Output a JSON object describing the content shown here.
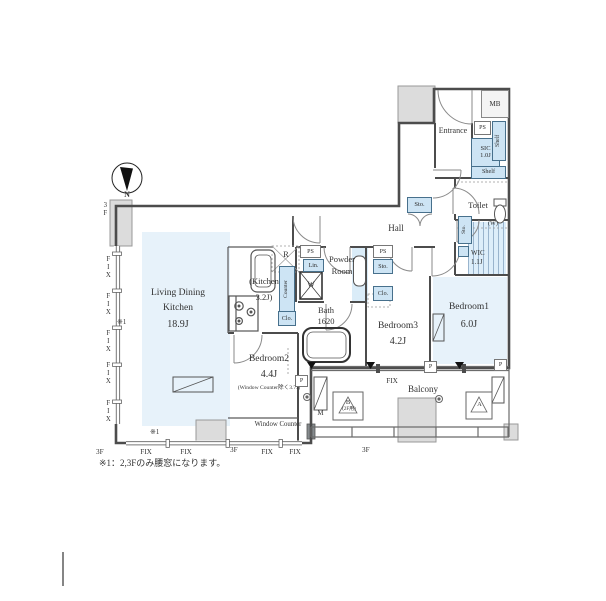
{
  "compass": {
    "north_label": "N"
  },
  "note": "※1：2,3Fのみ腰窓になります。",
  "rooms": {
    "ldk": {
      "name1": "Living Dining",
      "name2": "Kitchen",
      "size": "18.9J"
    },
    "kitchen": {
      "name": "(Kitchen",
      "size": "3.2J)"
    },
    "powder_room": {
      "name1": "Powder",
      "name2": "Room"
    },
    "bath": {
      "name": "Bath",
      "size": "1620"
    },
    "bedroom1": {
      "name": "Bedroom1",
      "size": "6.0J"
    },
    "bedroom2": {
      "name": "Bedroom2",
      "size": "4.4J",
      "note": "(Window Counter除く3.7J)"
    },
    "bedroom3": {
      "name": "Bedroom3",
      "size": "4.2J"
    },
    "hall": {
      "name": "Hall"
    },
    "entrance": {
      "name": "Entrance"
    },
    "toilet": {
      "name": "Toilet"
    },
    "wic": {
      "name": "WIC",
      "size": "1.1J"
    },
    "sic": {
      "name": "SIC",
      "size": "1.0J"
    },
    "balcony": {
      "name": "Balcony"
    }
  },
  "fixtures": {
    "mb": "MB",
    "ps": "PS",
    "lin": "Lin.",
    "sto": "Sto.",
    "clo": "Clo.",
    "shelf": "Shelf",
    "counter": "Counter",
    "fridge": "R",
    "washer": "W",
    "washer_place": "(W)",
    "meter": "M",
    "pipe": "P",
    "ac_unit_a": "A",
    "ac_unit_b": "B",
    "ac_unit_b_note": "(2F用)"
  },
  "marks": {
    "fix": "FIX",
    "floor_3f": "3F",
    "note_ref": "※1",
    "window_counter": "Window Counter"
  },
  "colors": {
    "room_fill": "#e7f2fa",
    "fixture_fill": "#cde4f4",
    "wall": "#4c4c4c"
  }
}
